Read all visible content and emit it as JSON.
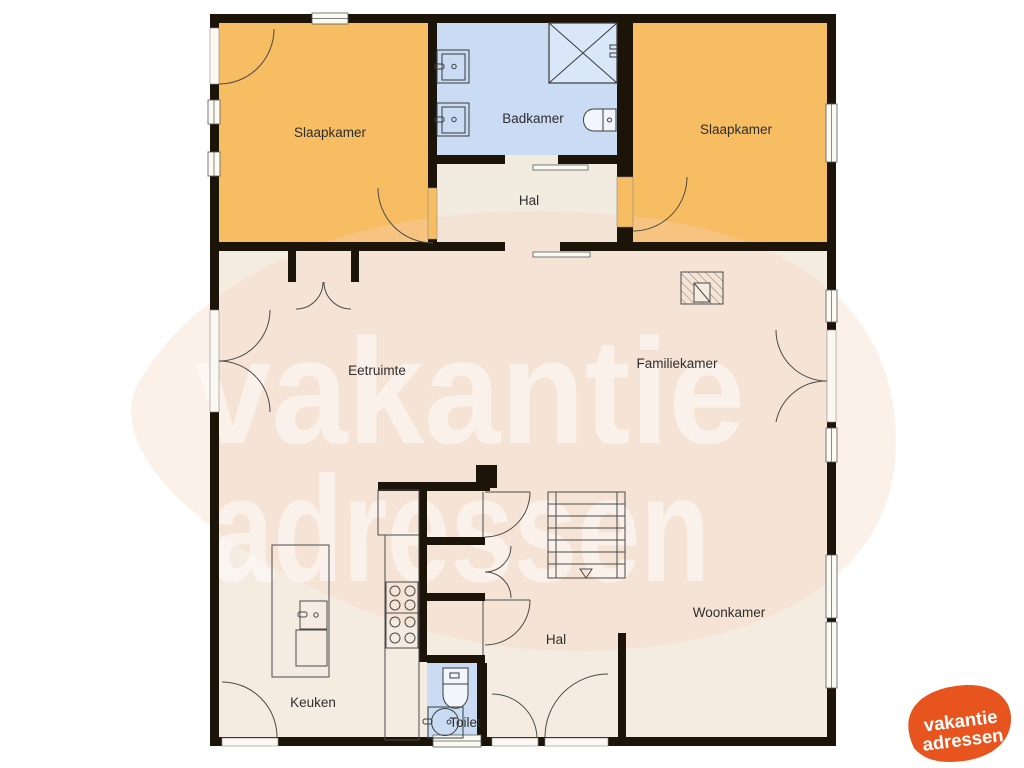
{
  "title": "Floor plan",
  "rooms": {
    "slaapkamer_left": "Slaapkamer",
    "badkamer": "Badkamer",
    "slaapkamer_right": "Slaapkamer",
    "hal_upper": "Hal",
    "eetruimte": "Eetruimte",
    "familiekamer": "Familiekamer",
    "woonkamer": "Woonkamer",
    "keuken": "Keuken",
    "hal_lower": "Hal",
    "toilet": "Toilet"
  },
  "watermark": {
    "line1": "vakantie",
    "line2": "adressen"
  },
  "logo": {
    "line1": "vakantie",
    "line2": "adressen"
  },
  "colors": {
    "bedroom_fill": "#f7bd63",
    "bathroom_fill": "#c9dcf4",
    "hall_fill": "#f2ebe0",
    "floor_fill": "#f5ece1",
    "wall": "#1d1409",
    "line": "#4a4a4a",
    "logo_orange": "#e8541e",
    "watermark_pink": "#f7d4bd",
    "background": "#ffffff"
  }
}
